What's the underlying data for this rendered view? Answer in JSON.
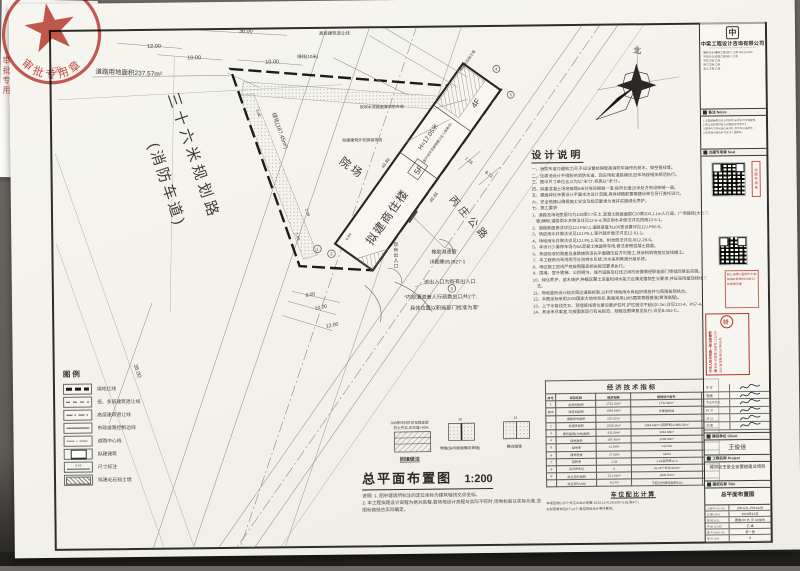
{
  "scan": {
    "stamp_arc": "审批专用章",
    "stamp_num": "(2)",
    "stamp_fragment": "审批专用"
  },
  "north_label": "北",
  "plan": {
    "road36_line1": "三十六米规划路",
    "road36_line2": "(消防车道)",
    "road_area": "道路用地面积237.57m²",
    "green_strip": "绿化(187.45m²)",
    "courtyard": "院场",
    "highway": "丙庄公路",
    "building": {
      "name": "拟建商住楼",
      "floors": "5F",
      "floors_end": "4F",
      "height": "H=17.05米",
      "height_note": "(室外地坪至建筑檐口女儿墙高点)"
    },
    "labels": {
      "setback_low": "低、多层建筑退让线",
      "setback_high": "高层建筑退让线",
      "green_line": "绿线(10米)",
      "outline": "拟建建筑外轮廓装饰线",
      "existing_road": "现状水泥路面兼消防车道",
      "retaining_wall": "拟建毛石挡土墙",
      "entrance_existing": "现有出入口",
      "exit_note": "该出入口为既有出入口",
      "speed_bump": "橡胶减速挡",
      "speed_bump_ref": "详图集05J927-1",
      "passage_note1": "“内部通道兼人行疏散出口共2个,",
      "passage_note2": "具体位置以职能部门批准为准”"
    },
    "dims": {
      "t36": "36.00",
      "t12": "12.00",
      "t10a": "10.00",
      "t10b": "10.00",
      "b8": "8.00",
      "b10": "10.00",
      "b12": "12.00",
      "b36": "36.00",
      "d208": "2.08",
      "d106": "1.06",
      "d064": "0.64",
      "d348": "3.48",
      "d726": "7.26",
      "d872": "8.72",
      "len_low": "40.86",
      "len_up": "43.86"
    },
    "bubbles": [
      "1",
      "2",
      "3",
      "4",
      "5"
    ]
  },
  "design_notes": {
    "title": "设计说明",
    "lines": [
      "一、消防车道与建筑之间,不应设置妨碍登高消防车操作的树木、架空管线等。",
      "二、化粪池设计不得影响消防车道、回车场和道路铺设,回车场按相关规范执行。",
      "三、图中尺寸单位含义均以“米”计,标高以“米”计。",
      "四、拟建混凝土场地每隔6米分块设缩缝一道,纵向长度20米处方向设伸缝一道。",
      "五、屋面绿化布置设计不属本次设计范围,具体绿植配置需建设单位另行委托设计。",
      "六、安全措施以确保施工安全及规范要求为准并实施绿化养护。",
      "七、施工要求:",
      "1、道路及场地垫层均为100厚3:7灰土,混凝土路面面层C30厚200,1.1m人行道、广场铺砖(大青石板)铺地;道路雨水井做法详见12-6-4,场区雨水井做法详见西南12-6-1。",
      "2、道路断面做法详见12J.P50.1,道路宽度为100宽设置详见12J.P50.8。",
      "3、场区雨水井做法详见12J.P6.1,室外踏步做法详见12-61-1。",
      "4、场地雨水井做法详见12J.P6.2,花池、树池做法详见J812-29-6。",
      "5、本设计少量停车场为6A混凝土地面停车场,做法参照混凝土路面。",
      "6、未经验收的路基及道路铺筑须先平整碾压后方可施工,其余构筑物按位放线施工。",
      "7、本工程雨污采用雨污分流排水系统,污水采用管渠分级系统。",
      "8、场区施工放线严格按照国家相关规范要求执行。",
      "9、围墙、室外楼梯、公用明沟、城市道路及红线之间的设置需经职能部门审批同意后实施。",
      "10、绿化养护、苗木维护,种植区覆土深度和排水能力应满足植物生长要求,并应采用屋顶绿化方式。",
      "11、场地竖向设计结合周边道路标高,以利于场地雨水有组织排放并与周围景观结合。",
      "12、本图坐标采用2000国家大地坐标系,高程采用1985国家高程基准(黄海高程)。",
      "13、上下水管线交叉、预埋管线等位置设置护栏时,护栏做法不超过0.2m,详见13J-4、P57-4。",
      "14、其余未尽事宜,均按国家现行有关规范、规程及图审意见执行,详见B.052-C。"
    ]
  },
  "econ": {
    "title": "经济技术指标",
    "headers": [
      "序号",
      "项目名称",
      "经济指标",
      "规划设计条件",
      "备注"
    ],
    "rows": [
      [
        "1",
        "总用地面积",
        "1732.20m²",
        "1732.60m²",
        ""
      ],
      [
        "其中",
        "净用地面积",
        "1494.63m²",
        "计算指标值",
        ""
      ],
      [
        "",
        "道路用地面积",
        "237.57m²",
        "",
        ""
      ],
      [
        "2",
        "总建筑面积",
        "1533.11m²",
        "1494.63m²×(容积率)≤2989.26m²",
        ""
      ],
      [
        "3",
        "建筑基底(占地)面积",
        "411.00m²",
        "≤642.68m²",
        ""
      ],
      [
        "4",
        "绿地面积",
        "187.45m²",
        "≥186.83m²",
        ""
      ],
      [
        "5",
        "绿地率",
        "12.54%",
        "≥12.5%",
        ""
      ],
      [
        "6",
        "建筑密度",
        "27.50%",
        "≤43%",
        ""
      ],
      [
        "7",
        "容积率",
        "1.03",
        "1.0≤容积率≤2.0",
        ""
      ],
      [
        "8",
        "宅内停车位",
        "6",
        "≥0.25个车位/100m²",
        ""
      ],
      [
        "9",
        "商业部分面积",
        "121.41m²",
        "≤931.51m²",
        ""
      ],
      [
        "",
        "商业部分占比",
        "8.27%",
        "不超过总建筑面积50%",
        ""
      ]
    ]
  },
  "parking": {
    "title": "车位配比计算",
    "lines": [
      "本项目按0.25个车位/100m²配置:1533.11×0.25/100=3.83,取4个。",
      "实际配置车位6个≥4个,满足规划设计条件要求。"
    ]
  },
  "legend": {
    "title": "图例",
    "items": [
      {
        "label": "用地红线",
        "style": "redline"
      },
      {
        "label": "低、多层建筑退让线",
        "style": "dash"
      },
      {
        "label": "高层建筑退让线",
        "style": "dashdot"
      },
      {
        "label": "市政道路控制边线",
        "style": "solid"
      },
      {
        "label": "道路中心线",
        "style": "centerline"
      },
      {
        "label": "拟建建筑",
        "style": "building"
      },
      {
        "label": "尺寸标注",
        "style": "dim",
        "value": "8.62"
      },
      {
        "label": "拟建毛石挡土墙",
        "style": "wall"
      }
    ]
  },
  "details": {
    "backfill_label": "回填做法",
    "backfill_note1": "200厚块石挤淤至稳定层",
    "backfill_note2": "夯土夯实,压实度>93%",
    "joint1_label": "伸缝(纵向缩缝横向伸缝)",
    "joint2_label": "横向缩缝",
    "joint1_dim": "20",
    "joint2_dim": "14"
  },
  "main_title": {
    "text": "总平面布置图",
    "scale": "1:200"
  },
  "bottom_notes": [
    "说明: 1. 图中建筑所标注的定位坐标为建筑轴线交点坐标。",
    "2. 本工程拟建设计高程为绝对高程,若场地设计高程与实际不符时,场地标高以实际为准,总图标高结合实际确定。"
  ],
  "titleblock": {
    "logo_char": "中",
    "company": "中梁工程设计咨询有限公司",
    "company_en": "ZHONGLIANG ENGINEERING DESIGN CONSULTING CO.,LTD.",
    "credentials": [
      "建筑行业(建筑工程)设计 乙级 A51310364",
      "市政行业(道路工程)设计 乙级",
      "市政工程 乙级",
      "电力工程 乙级",
      "岩土工程 乙级"
    ],
    "notes_title": "备注 Notes",
    "notes": [
      "1.本图纸版权归本公司所有,未经许可不得复制。",
      "2.施工前应核对各专业图纸及现场尺寸。",
      "3.图中尺寸除标高以米计外,其余均以毫米计。",
      "4.如有疑问请及时与设计人员联系。"
    ],
    "seal_title": "出图专用章 Seal",
    "seal_side": "出图专用章",
    "review_line1": "四川省施工图设计文件",
    "review_line2": "审查专用章",
    "review_line3": "2023年12月审查合格",
    "architect_stamp": {
      "title": "中华人民共和国一级注册建筑师",
      "name": "姓名:华俊康",
      "reg": "注册号:1312X5-082",
      "valid": "有效期:至2027年04月",
      "seal_char": "章"
    },
    "sign_roles": [
      "审 定",
      "审 核",
      "专业负责人",
      "校 对",
      "设 计",
      "制 图"
    ],
    "client_title": "建设单位 Client",
    "client": "王俊佳",
    "project_title": "工程名称 Project",
    "project": "城郊区王俊业安置楼建设项目",
    "drawing_title": "图纸名称 Title",
    "drawing": "总平面布置图",
    "info_rows": [
      [
        "工程号 PRJ.NO",
        "ZW-CZL-2021A28"
      ],
      [
        "日 期 DATE",
        "2023年12月"
      ],
      [
        "图 幅 SIZE",
        "建施-06 共 页 A0加长"
      ],
      [
        "等 级 CLASS",
        "乙 级"
      ],
      [
        "图 号 DWG.NO",
        "第一张"
      ],
      [
        "版 次 VER.",
        "0"
      ]
    ]
  }
}
